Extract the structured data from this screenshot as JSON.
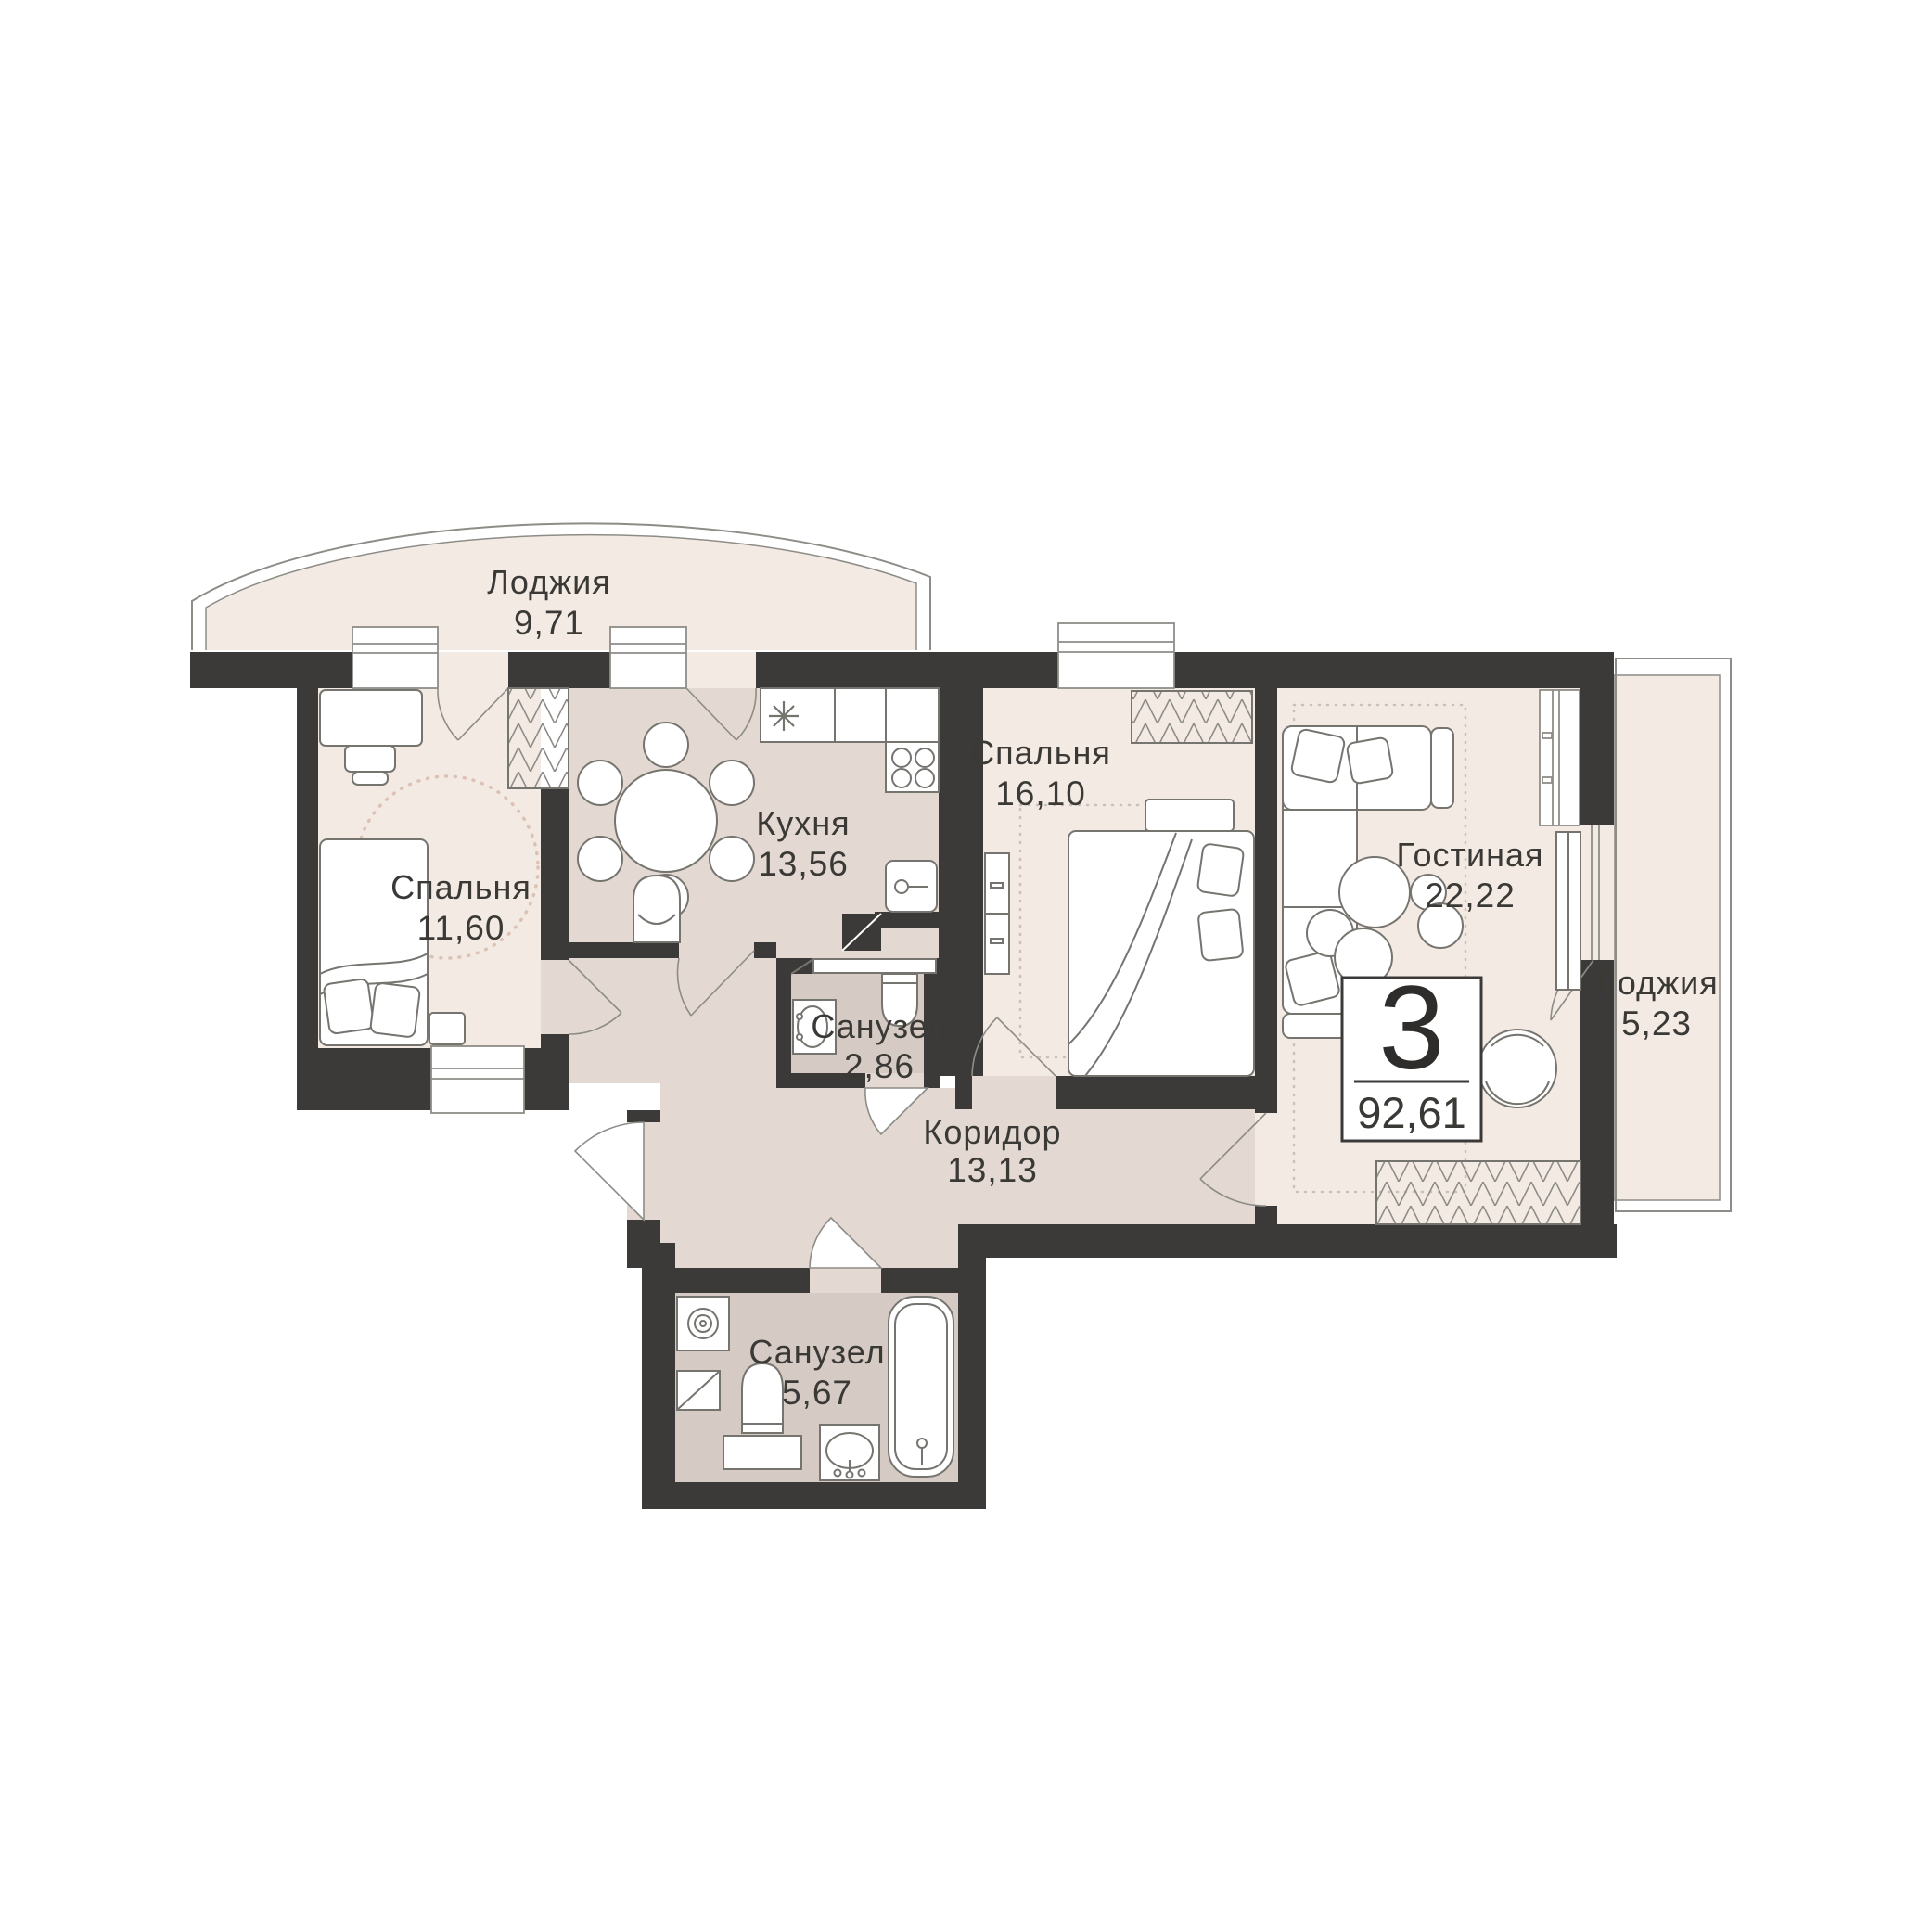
{
  "plan": {
    "title": "Apartment floor plan",
    "badge": {
      "rooms_count": "3",
      "total_area": "92,61"
    },
    "rooms": {
      "loggia_top": {
        "name": "Лоджия",
        "area": "9,71"
      },
      "bedroom_left": {
        "name": "Спальня",
        "area": "11,60"
      },
      "kitchen": {
        "name": "Кухня",
        "area": "13,56"
      },
      "bedroom_middle": {
        "name": "Спальня",
        "area": "16,10"
      },
      "living": {
        "name": "Гостиная",
        "area": "22,22"
      },
      "loggia_right": {
        "name": "Лоджия",
        "area": "5,23"
      },
      "bathroom_small": {
        "name": "Санузел",
        "area": "2,86"
      },
      "corridor": {
        "name": "Коридор",
        "area": "13,13"
      },
      "bathroom_large": {
        "name": "Санузел",
        "area": "5,67"
      }
    },
    "colors": {
      "wall": "#3b3a38",
      "floor_light_pink": "#f4eae4",
      "floor_taupe": "#e3d9d2",
      "floor_bath": "#d5cbc4",
      "outline": "#8e8c87",
      "furniture_line": "#76746f",
      "accent_dots": "#dcc2b4",
      "text": "#3a3936"
    }
  }
}
